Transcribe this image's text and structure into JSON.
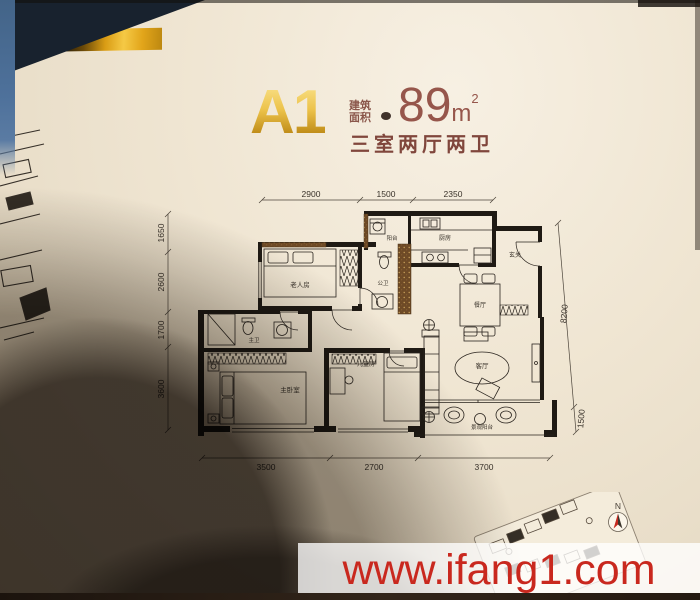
{
  "header": {
    "plan_code": "A1",
    "area_label_line1": "建筑",
    "area_label_line2": "面积",
    "area_value": "89",
    "area_unit": "m",
    "area_sup": "2",
    "layout_text": "三室两厅两卫"
  },
  "plan": {
    "dims": {
      "top": [
        "2900",
        "1500",
        "2350"
      ],
      "left": [
        "1650",
        "2600",
        "1700",
        "3600"
      ],
      "right": [
        "8200",
        "1500"
      ],
      "bottom": [
        "3500",
        "2700",
        "3700"
      ]
    },
    "rooms": {
      "elder": "老人房",
      "balcony": "阳台",
      "kitchen": "厨房",
      "foyer": "玄关",
      "bathPub": "公卫",
      "dining": "餐厅",
      "bathMaster": "主卫",
      "master": "主卧室",
      "kids": "儿童房",
      "living": "客厅",
      "balconyView": "景观阳台"
    }
  },
  "compass": {
    "label": "N"
  },
  "watermark": {
    "text": "www.ifang1.com"
  },
  "colors": {
    "gold_accent": "#e8b429",
    "title_red_brown": "#8f4f44",
    "watermark_red": "#c9281e",
    "page_cream": "#efe5d2"
  }
}
